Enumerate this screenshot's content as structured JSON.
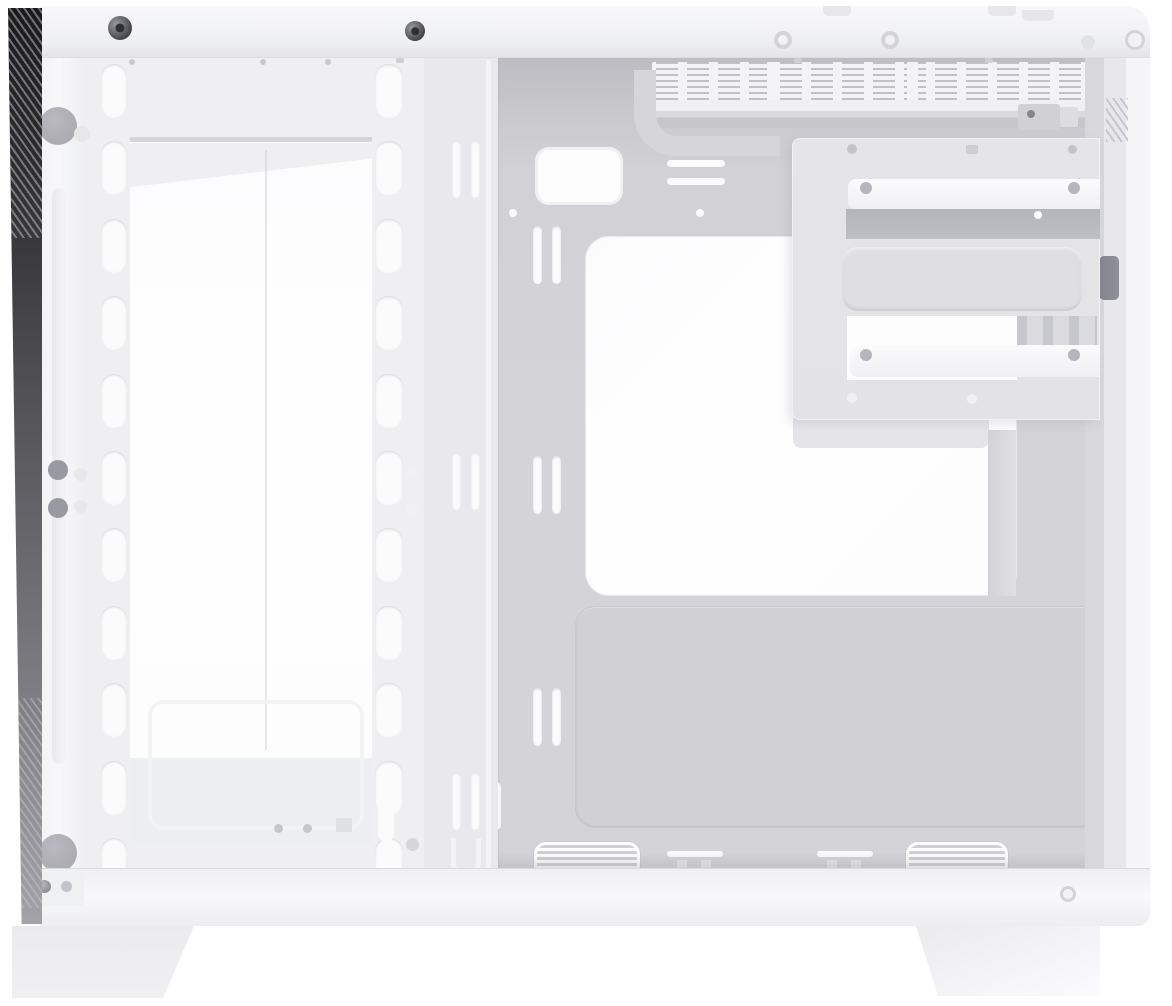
{
  "scene": {
    "type": "product-photo",
    "subject": "White mid-tower PC case shown from the side with panels removed",
    "view": "interior side view, front panel at left, rear at right, two feet at bottom",
    "visible_text": ""
  },
  "palette": {
    "background": "#ffffff",
    "frame": "#f1f1f4",
    "frame_bright": "#f8f8fa",
    "frame_edge": "#dfdfe3",
    "fan_frame": "#efeff2",
    "column": "#e9e9ed",
    "pillar": "#f5f5f8",
    "groove": "#e9e9ed",
    "opening": "#fdfdfe",
    "opening_shade": "#ebebee",
    "shelf": "#edeef1",
    "tray": "#d4d4d8",
    "tray_shadow": "#bcbcc2",
    "tray_lip": "#d6d6da",
    "stamp_panel": "#d1d1d5",
    "cage": "#e3e3e6",
    "cage_recess": "#bebec5",
    "cage_mid": "#dfdfe3",
    "rail_white": "#f7f7f9",
    "vent_bg": "#f3f3f5",
    "vent_dash": "#9d9da5",
    "slot_white": "#fbfbfc",
    "slot_dark": "#8f8f99",
    "hole_gray": "#ababb1",
    "hole_ring": "#d3d3d8",
    "screw_dark": "#45454b",
    "screw_mid": "#8a8a91",
    "glass_dark": "#1a1a1c",
    "glass_light": "#a2a2a8",
    "foot": "#f0f0f3"
  },
  "counts": {
    "fan_rail_slots_left": 11,
    "fan_rail_slots_right": 11
  },
  "parts": {
    "glass_edge": "tempered glass front edge (dark strip)",
    "front_pillar": "front frame pillar with thumbscrew holes",
    "fan_bracket": "front fan / radiator mounting rails",
    "front_opening": "front intake opening (bright diffuser)",
    "motherboard_tray": "motherboard tray",
    "cpu_cutout": "CPU cooler backplate cutout",
    "cable_grommet": "cable routing cutouts",
    "top_vents": "top ventilation slot panel",
    "drive_cage": "side-mounted 3.5/2.5 inch drive bracket",
    "psu_panel": "stamped power-supply bay panel",
    "bottom_vents": "bottom cable / vent cutouts",
    "feet": "case feet"
  }
}
